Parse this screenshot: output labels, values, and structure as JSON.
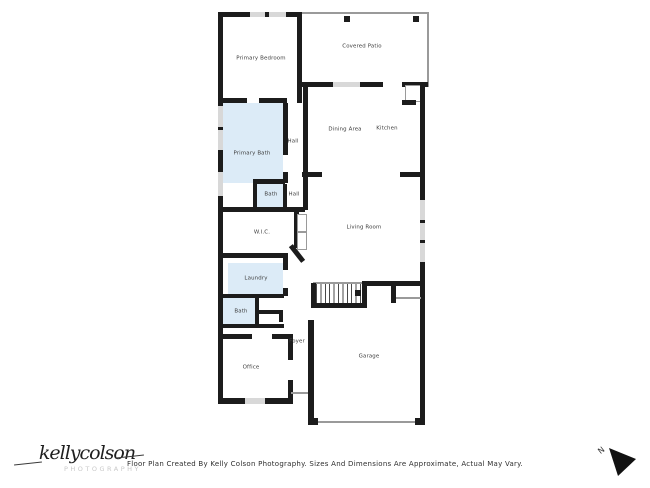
{
  "colors": {
    "wall": "#1c1c1c",
    "room_fill": "#dcebf7",
    "window": "#d8d8d8",
    "thin_line": "#9a9a9a"
  },
  "floorplan": {
    "rooms": [
      {
        "label": "Primary Bedroom"
      },
      {
        "label": "Covered Patio"
      },
      {
        "label": "Primary Bath"
      },
      {
        "label": "Hall"
      },
      {
        "label": "Dining Area"
      },
      {
        "label": "Kitchen"
      },
      {
        "label": "Bath"
      },
      {
        "label": "Hall"
      },
      {
        "label": "W.I.C."
      },
      {
        "label": "Living Room"
      },
      {
        "label": "Laundry"
      },
      {
        "label": "Bath"
      },
      {
        "label": "Foyer"
      },
      {
        "label": "Office"
      },
      {
        "label": "Garage"
      }
    ]
  },
  "footer": {
    "disclaimer": "Floor Plan Created By Kelly Colson Photography. Sizes And Dimensions Are Approximate, Actual May Vary."
  },
  "branding": {
    "script": "kellycolson",
    "sub": "PHOTOGRAPHY"
  },
  "compass": {
    "label": "N"
  }
}
